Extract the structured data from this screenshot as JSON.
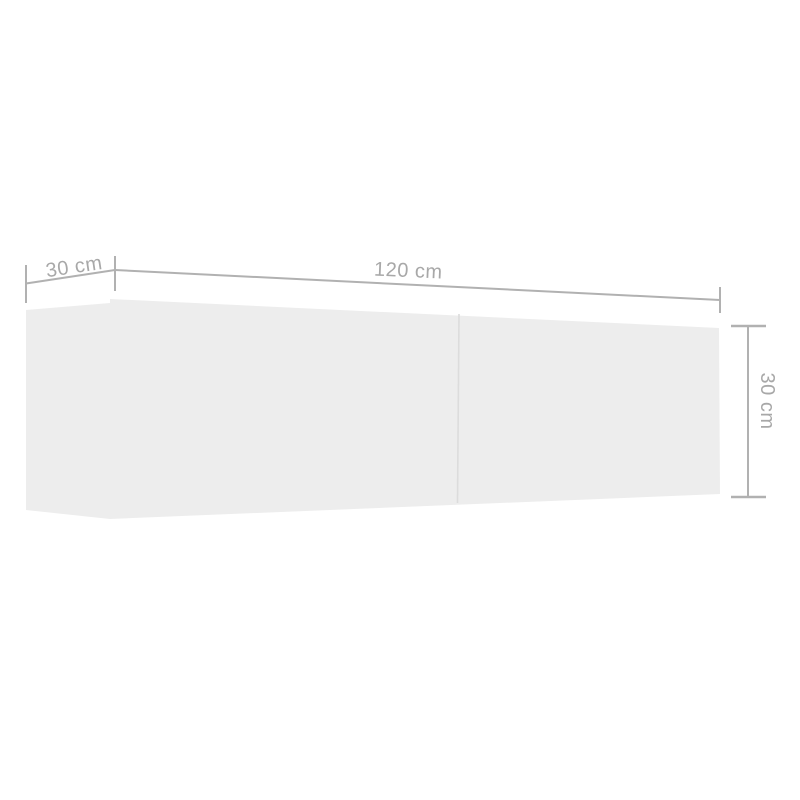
{
  "diagram": {
    "kind": "product-dimension-diagram",
    "background_color": "#ffffff",
    "dimensions": {
      "depth": {
        "label": "30 cm",
        "position": "top-left"
      },
      "width": {
        "label": "120 cm",
        "position": "top"
      },
      "height": {
        "label": "30 cm",
        "position": "right"
      }
    },
    "colors": {
      "dimension_line": "#b1b1b1",
      "dimension_text": "#a8a8a8",
      "cabinet_face": "#ededed",
      "door_seam": "#dcdcdc"
    }
  }
}
